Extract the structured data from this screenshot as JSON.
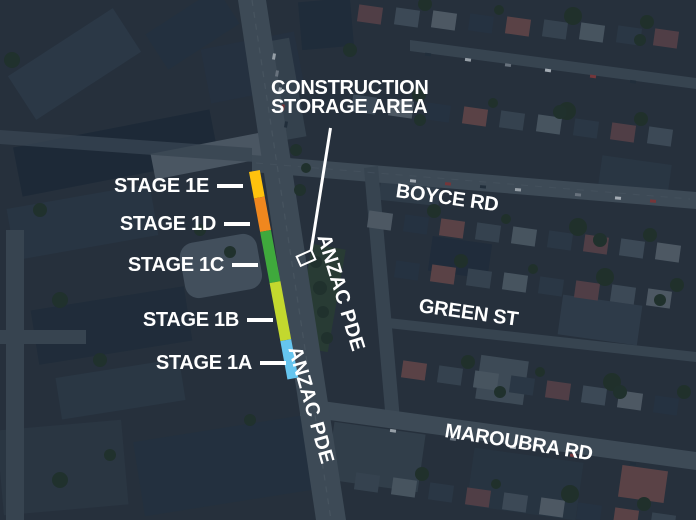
{
  "construction_area": {
    "label_lines": [
      "CONSTRUCTION",
      "STORAGE AREA"
    ]
  },
  "roads": {
    "boyce": "BOYCE RD",
    "green": "GREEN ST",
    "maroubra": "MAROUBRA RD",
    "anzac_upper": "ANZAC PDE",
    "anzac_lower": "ANZAC PDE"
  },
  "stages": [
    {
      "label": "STAGE 1E",
      "color": "#FFC20D",
      "segment_length_px": 27
    },
    {
      "label": "STAGE 1D",
      "color": "#F0871E",
      "segment_length_px": 34
    },
    {
      "label": "STAGE 1C",
      "color": "#3FA93C",
      "segment_length_px": 52
    },
    {
      "label": "STAGE 1B",
      "color": "#C3D82E",
      "segment_length_px": 59
    },
    {
      "label": "STAGE 1A",
      "color": "#66C5EF",
      "segment_length_px": 39
    }
  ],
  "annotation_color": "#FFFFFF"
}
